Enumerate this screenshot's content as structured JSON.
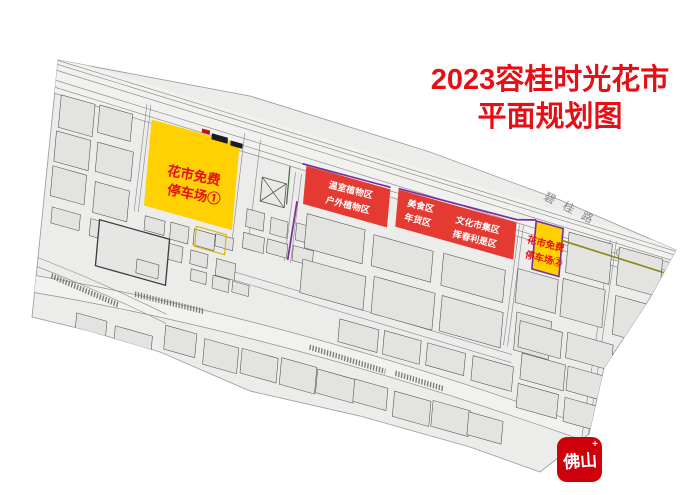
{
  "title": {
    "line1": "2023容桂时光花市",
    "line2": "平面规划图"
  },
  "zones": {
    "parking1": {
      "line1": "花市免费",
      "line2": "停车场①"
    },
    "parking2": {
      "line1": "花市免费",
      "line2": "停车场②"
    },
    "plants": {
      "line1": "温室植物区",
      "line2": "户外植物区"
    },
    "food": {
      "line1": "美食区",
      "line2": "年货区"
    },
    "culture": {
      "line1": "文化市集区",
      "line2": "挥春利是区"
    }
  },
  "road": {
    "label": "碧桂路"
  },
  "logo": {
    "text": "佛山",
    "plus": "+"
  },
  "colors": {
    "title_red": "#e60f16",
    "label_red": "#e60f16",
    "zone_red": "#e43a32",
    "zone_text": "#ffffff",
    "parking_yellow": "#ffd103",
    "route_purple": "#7a2f9e",
    "route_olive": "#8a8a1a",
    "road_label_gray": "#8a8a8a",
    "logo_red": "#ce000c"
  }
}
